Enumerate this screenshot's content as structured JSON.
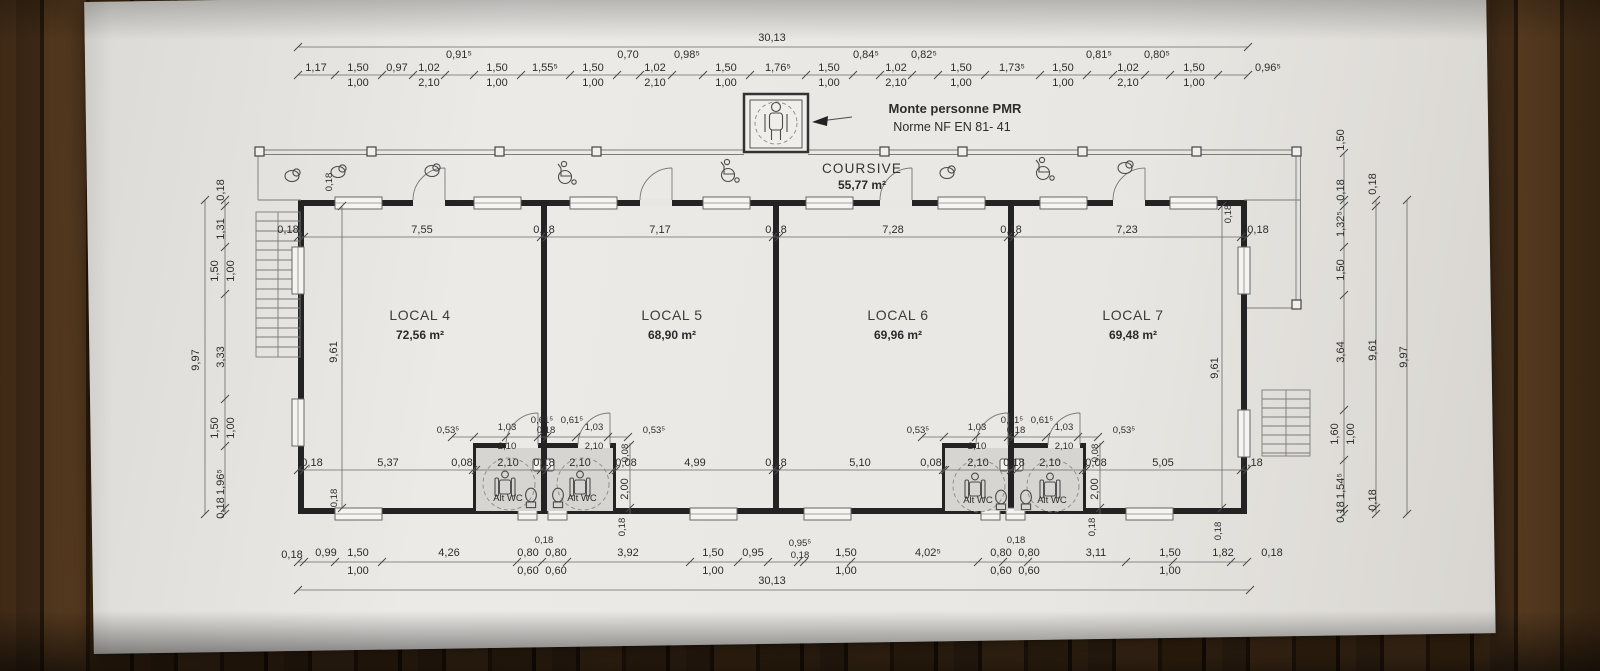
{
  "plan": {
    "overall_top": "30,13",
    "overall_bottom": "30,13",
    "elevator": {
      "title": "Monte personne PMR",
      "subtitle": "Norme NF EN 81- 41"
    },
    "coursive": {
      "name": "COURSIVE",
      "area": "55,77 m²"
    },
    "rooms": [
      {
        "name": "LOCAL 4",
        "area": "72,56 m²"
      },
      {
        "name": "LOCAL 5",
        "area": "68,90 m²"
      },
      {
        "name": "LOCAL 6",
        "area": "69,96 m²"
      },
      {
        "name": "LOCAL 7",
        "area": "69,48 m²"
      }
    ],
    "wc_label": "Alt WC",
    "top_chain": [
      "1,17",
      "1,50",
      "1,00",
      "0,97",
      "1,02",
      "2,10",
      "0,91⁵",
      "1,50",
      "1,00",
      "1,55⁵",
      "1,50",
      "1,00",
      "0,70",
      "1,02",
      "2,10",
      "0,98⁵",
      "1,50",
      "1,00",
      "1,76⁵",
      "1,50",
      "1,00",
      "0,84⁵",
      "1,02",
      "2,10",
      "0,82⁵",
      "1,50",
      "1,00",
      "1,73⁵",
      "1,50",
      "1,00",
      "0,81⁵",
      "1,02",
      "2,10",
      "0,80⁵",
      "1,50",
      "1,00",
      "0,96⁵"
    ],
    "interior_top": [
      "0,18",
      "7,55",
      "0,18",
      "7,17",
      "0,18",
      "7,28",
      "0,18",
      "7,23",
      "0,18"
    ],
    "interior_bottom": [
      "0,18",
      "5,37",
      "0,08",
      "2,10",
      "0,18",
      "2,10",
      "0,08",
      "4,99",
      "0,18",
      "5,10",
      "0,08",
      "2,10",
      "0,18",
      "2,10",
      "0,08",
      "5,05",
      "0,18"
    ],
    "bottom_chain": [
      "0,18",
      "0,99",
      "1,50",
      "1,00",
      "4,26",
      "0,18",
      "0,80",
      "0,60",
      "0,80",
      "0,60",
      "3,92",
      "1,50",
      "1,00",
      "0,95",
      "0,95⁵",
      "0,18",
      "1,50",
      "1,00",
      "4,02⁵",
      "0,18",
      "0,80",
      "0,60",
      "0,80",
      "0,60",
      "3,11",
      "1,50",
      "1,00",
      "1,82",
      "0,18"
    ],
    "left_chain": [
      "0,18",
      "1,31",
      "1,50",
      "1,00",
      "3,33",
      "1,50",
      "1,00",
      "1,96⁵",
      "0,18"
    ],
    "left_overall": "9,97",
    "right_chain": [
      "1,50",
      "0,18",
      "1,32⁵",
      "1,50",
      "3,64",
      "1,60",
      "1,00",
      "1,54⁵",
      "0,18"
    ],
    "right_inner": [
      "0,18",
      "9,61",
      "0,18"
    ],
    "right_overall": "9,97",
    "interior_height": "9,61",
    "wc_chain": [
      "0,53⁵",
      "1,03",
      "2,10",
      "0,61⁵",
      "0,18",
      "0,61⁵",
      "1,03",
      "2,10",
      "0,53⁵"
    ],
    "wc_vertical": [
      "0,08",
      "2,00",
      "0,18"
    ],
    "wall_thickness": "0,18"
  }
}
